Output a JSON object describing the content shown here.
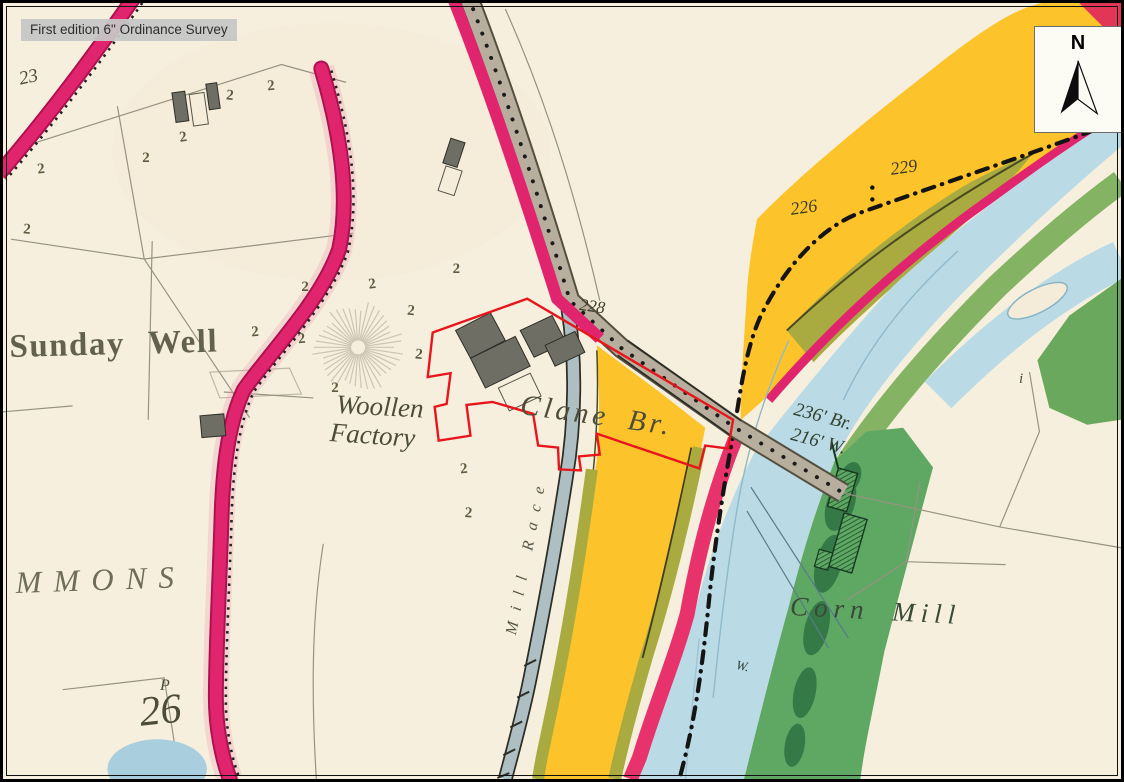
{
  "overlay": {
    "source_label": "First edition 6\" Ordinance Survey"
  },
  "compass": {
    "letter": "N"
  },
  "labels": {
    "sunday_well": "Sunday Well",
    "woollen_line1": "Woollen",
    "woollen_line2": "Factory",
    "clane_bridge": "Clane Br.",
    "bridge_length": "236' Br.",
    "water_width": "216' W.",
    "spot_height_229": "229",
    "spot_height_226": "226",
    "spot_height_228": "228",
    "corn_mill": "Corn Mill",
    "weir_w": "W.",
    "commons": "MMONS",
    "plot_letter_p": "P",
    "plot_26": "26",
    "plot_23": "23",
    "mill_race": "Mill Race",
    "townland_i": "i"
  },
  "colors": {
    "paper": "#f7efdd",
    "road_crimson": "#e0256e",
    "road_crimson_dark": "#b01050",
    "road_grey": "#b7ae9d",
    "river_blue": "#badbe6",
    "meadow_yellow": "#fcc32b",
    "olive_green": "#a9ab40",
    "bank_green": "#5ea863",
    "bank_green_light": "#84b363",
    "dark_green": "#2e7342",
    "site_outline_red": "#e8151c",
    "building_grey": "#6e6e64",
    "ink": "#4c4c3a",
    "line_grey": "#979381"
  },
  "symbols": {
    "tree_glyph": "2",
    "tree_positions": [
      [
        35,
        172,
        -6
      ],
      [
        20,
        232,
        5
      ],
      [
        140,
        160,
        0
      ],
      [
        178,
        140,
        -8
      ],
      [
        224,
        97,
        6
      ],
      [
        266,
        88,
        -5
      ],
      [
        300,
        290,
        0
      ],
      [
        368,
        288,
        -7
      ],
      [
        406,
        314,
        5
      ],
      [
        330,
        392,
        0
      ],
      [
        297,
        343,
        -6
      ],
      [
        414,
        358,
        6
      ],
      [
        452,
        272,
        0
      ],
      [
        460,
        474,
        -5
      ],
      [
        464,
        518,
        4
      ],
      [
        250,
        336,
        -4
      ]
    ],
    "sunburst": {
      "cx": 357,
      "cy": 347,
      "rays": 42,
      "r_inner": 7,
      "r_outer": 46
    }
  }
}
